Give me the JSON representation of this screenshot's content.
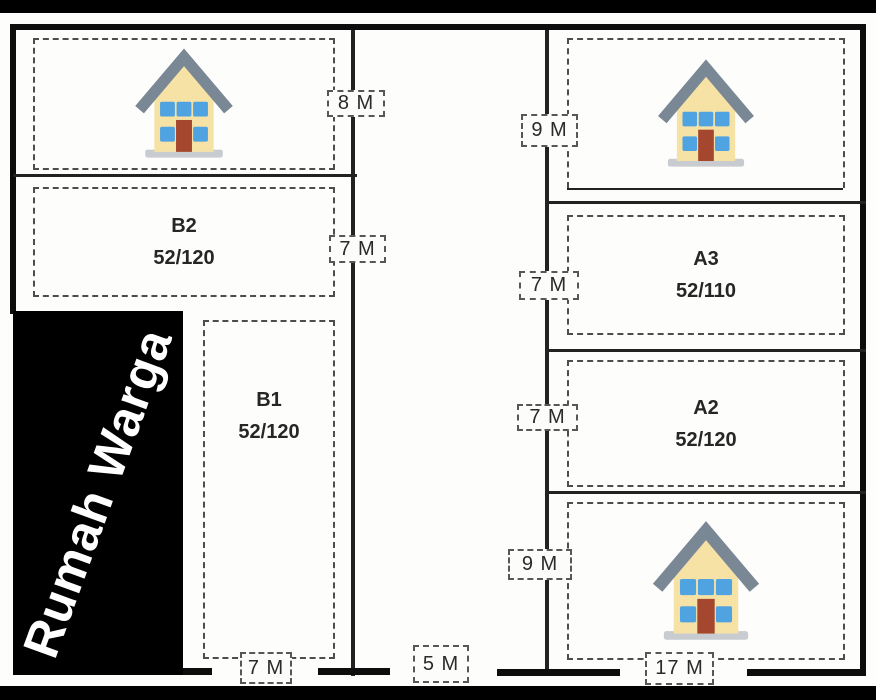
{
  "plan": {
    "area_label": "Rumah Warga",
    "lots": {
      "b2": {
        "name": "B2",
        "area": "52/120"
      },
      "b1": {
        "name": "B1",
        "area": "52/120"
      },
      "a3": {
        "name": "A3",
        "area": "52/110"
      },
      "a2": {
        "name": "A2",
        "area": "52/120"
      }
    },
    "dims": {
      "left_top": "8 M",
      "left_mid": "7 M",
      "right_top": "9 M",
      "right_a3": "7 M",
      "right_a2": "7 M",
      "right_bottom": "9 M",
      "bottom_left": "7 M",
      "bottom_mid": "5 M",
      "bottom_right": "17 M"
    },
    "icons": {
      "house": "house-icon"
    },
    "colors": {
      "outline": "#0d0d0d",
      "area_fill": "#000000",
      "area_text": "#ffffff",
      "house_body": "#f6e2a5",
      "house_roof": "#7a8794",
      "house_window": "#4fa3e0",
      "house_door": "#a5472e",
      "house_base": "#c8ccd0"
    }
  }
}
